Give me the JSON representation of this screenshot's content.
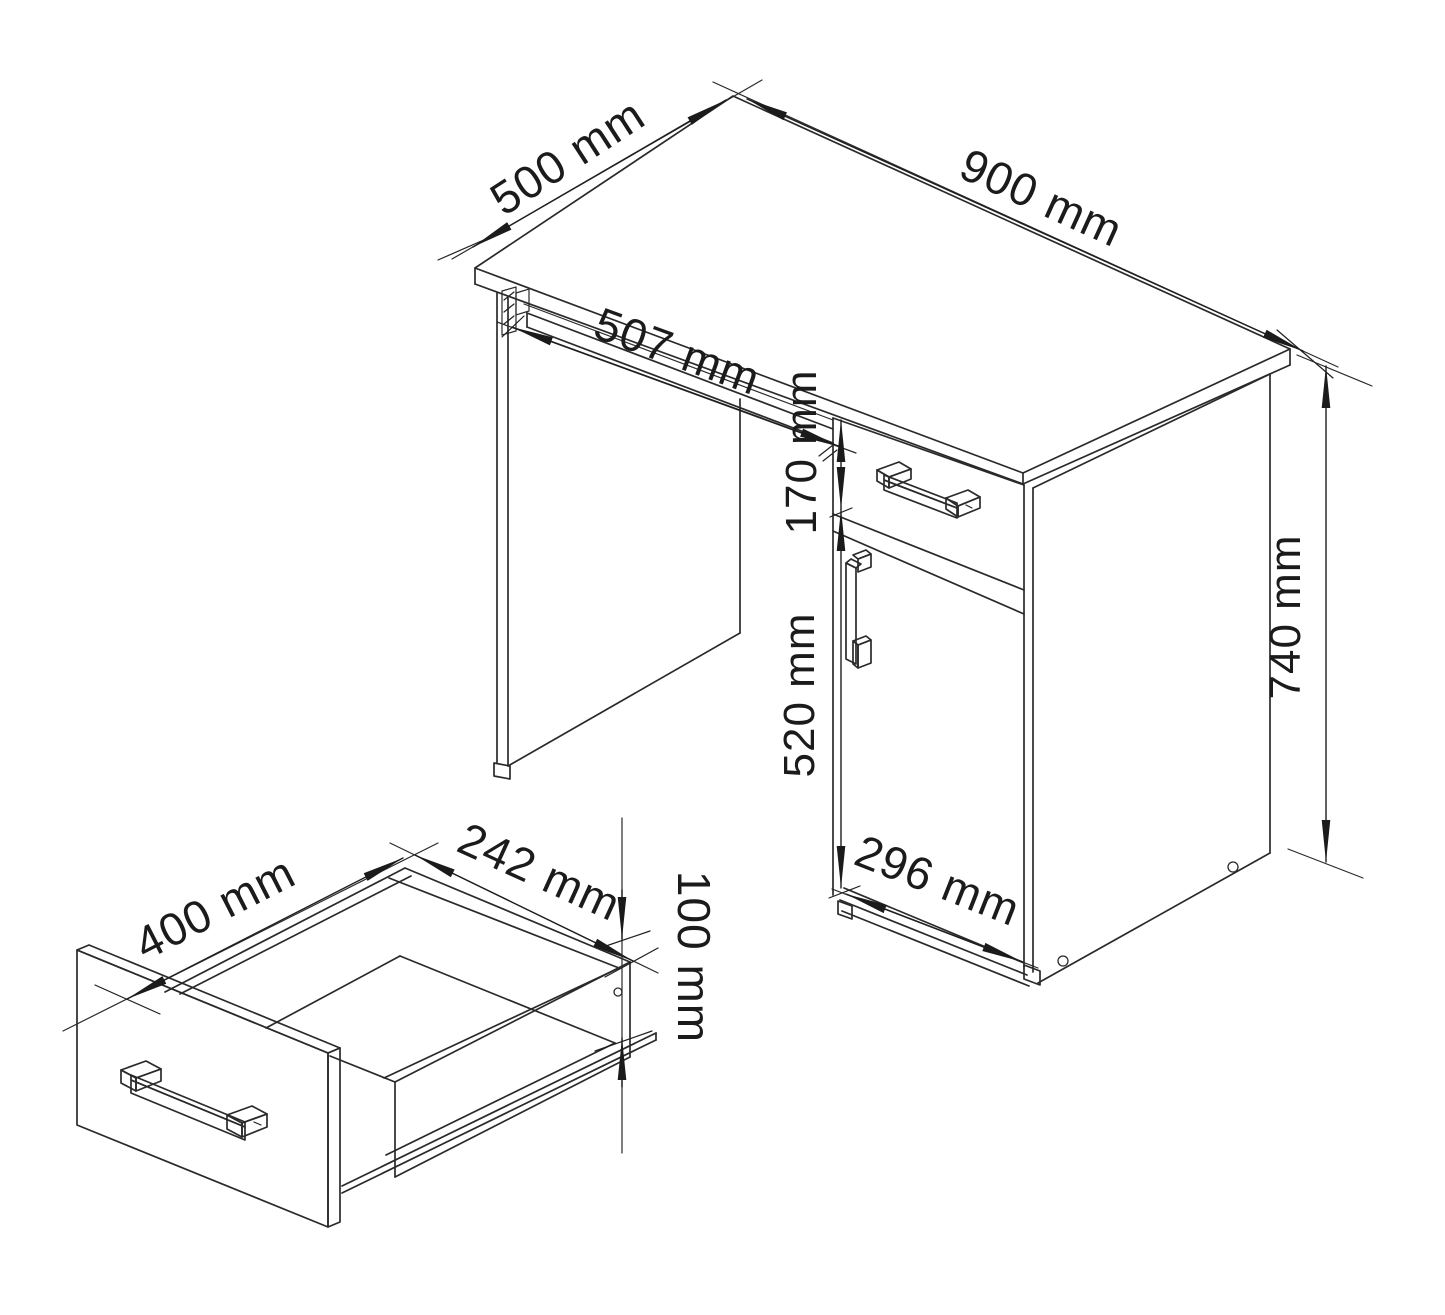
{
  "page": {
    "background": "#ffffff",
    "line_color": "#2a2a2a",
    "text_color": "#1b1b1b"
  },
  "desk_drawing": {
    "dimensions": {
      "top_depth": "500 mm",
      "top_width": "900 mm",
      "tray_width": "507 mm",
      "drawer_front_height": "170 mm",
      "door_height": "520 mm",
      "cabinet_width": "296 mm",
      "overall_height": "740 mm"
    }
  },
  "drawer_drawing": {
    "dimensions": {
      "depth": "400 mm",
      "inner_width": "242 mm",
      "height": "100 mm"
    }
  }
}
